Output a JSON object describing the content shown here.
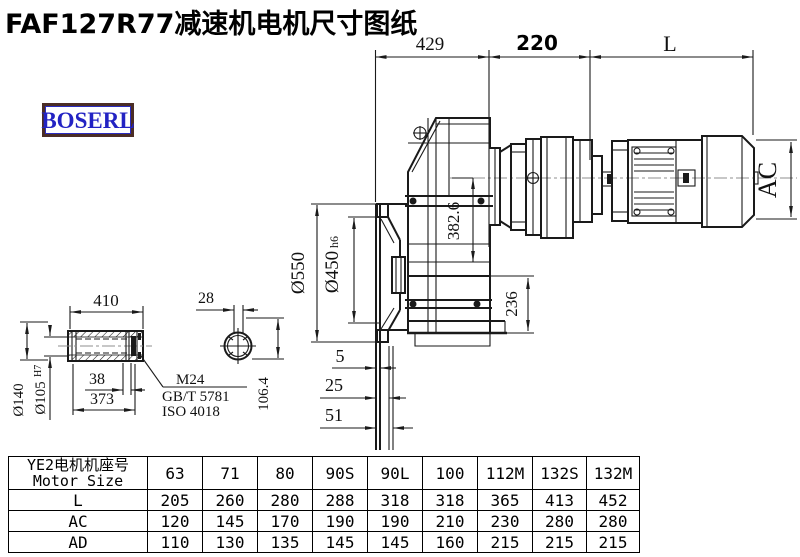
{
  "title": "FAF127R77减速机电机尺寸图纸",
  "logo": {
    "text": "BOSERL"
  },
  "colors": {
    "line": "#1a1a1a",
    "centerline": "#8f8f8f",
    "logo_text": "#2323c3",
    "logo_border": "#4b2d26"
  },
  "drawing": {
    "top_dims": {
      "left": "429",
      "middle": "220",
      "right": "L"
    },
    "motor_height": "AC",
    "axis_height": "382.6",
    "foot_height": "236",
    "flange_od": "Ø550",
    "spigot": "Ø450",
    "spigot_tol": "h6",
    "offset_5": "5",
    "offset_25": "25",
    "offset_51": "51",
    "shaft_len": "410",
    "bore_step": "38",
    "bore_depth": "373",
    "shaft_od": "Ø140",
    "bore_dia": "Ø105",
    "bore_tol": "H7",
    "key_width": "28",
    "key_height": "106.4",
    "screw": "M24",
    "screw_std1": "GB/T 5781",
    "screw_std2": "ISO 4018"
  },
  "table": {
    "header_cn": "YE2电机机座号",
    "header_en": "Motor Size",
    "sizes": [
      "63",
      "71",
      "80",
      "90S",
      "90L",
      "100",
      "112M",
      "132S",
      "132M"
    ],
    "rows": [
      {
        "label": "L",
        "values": [
          "205",
          "260",
          "280",
          "288",
          "318",
          "318",
          "365",
          "413",
          "452"
        ]
      },
      {
        "label": "AC",
        "values": [
          "120",
          "145",
          "170",
          "190",
          "190",
          "210",
          "230",
          "280",
          "280"
        ]
      },
      {
        "label": "AD",
        "values": [
          "110",
          "130",
          "135",
          "145",
          "145",
          "160",
          "215",
          "215",
          "215"
        ]
      }
    ]
  }
}
